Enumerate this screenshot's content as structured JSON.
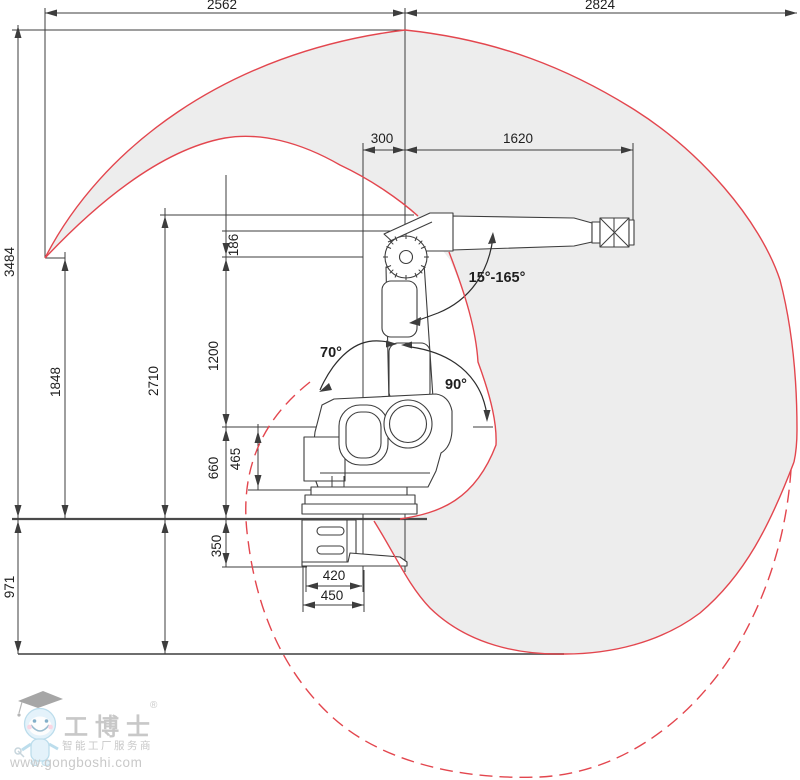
{
  "dimensions": {
    "top_left": "2562",
    "top_right": "2824",
    "arm_offset": "300",
    "upper_arm": "1620",
    "wrist_drop": "186",
    "lower_arm": "1200",
    "height_mid": "2710",
    "height_cusp": "1848",
    "height_total": "3484",
    "shoulder_height": "660",
    "base_height": "465",
    "riser_height": "350",
    "below_floor": "971",
    "base_inner": "420",
    "base_outer": "450"
  },
  "angles": {
    "wrist_range": "15°-165°",
    "rear_tilt": "70°",
    "front_tilt": "90°"
  },
  "watermark": {
    "brand": "工博士",
    "reg": "®",
    "tagline": "智能工厂服务商",
    "url": "www.gongboshi.com"
  },
  "colors": {
    "envelope_fill": "#ededed",
    "envelope_red": "#e3464e",
    "line": "#3d3d3d"
  }
}
